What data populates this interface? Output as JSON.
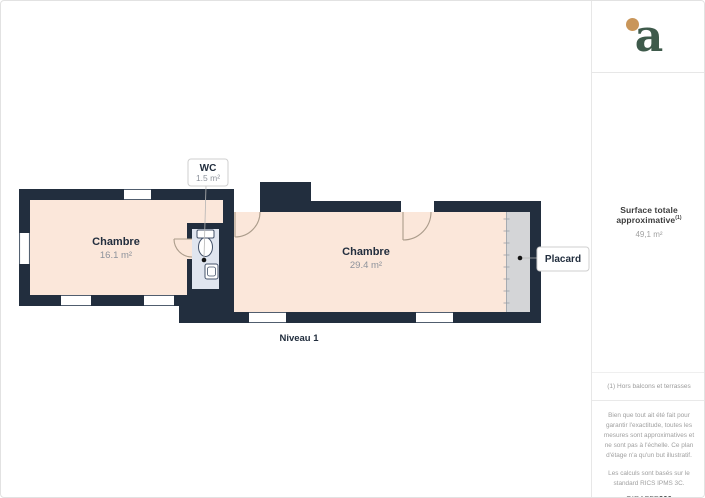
{
  "header": {
    "logo_letter": "a"
  },
  "plan": {
    "level_label": "Niveau 1",
    "room1": {
      "name": "Chambre",
      "area": "16.1 m²"
    },
    "room2": {
      "name": "Chambre",
      "area": "29.4 m²"
    },
    "wc": {
      "name": "WC",
      "area": "1.5 m²"
    },
    "placard_label": "Placard"
  },
  "sidebar": {
    "surface_title": "Surface totale approximative",
    "surface_note_ref": "(1)",
    "surface_value": "49,1 m²",
    "footnote": "(1) Hors balcons et terrasses",
    "disclaimer_p1": "Bien que tout ait été fait pour garantir l'exactitude, toutes les mesures sont approximatives et ne sont pas à l'échelle. Ce plan d'étage n'a qu'un but illustratif.",
    "disclaimer_p2": "Les calculs sont basés sur le standard RICS IPMS 3C.",
    "brand_prefix": "GIRAFFE",
    "brand_suffix": "360"
  },
  "colors": {
    "wall": "#222e3e",
    "floor": "#fbe7da",
    "wc_floor": "#e0e5ef",
    "placard": "#d4d5d7",
    "door_arc": "#ab9c8b",
    "logo_green": "#3e5a4b",
    "logo_gold": "#c9965a"
  }
}
